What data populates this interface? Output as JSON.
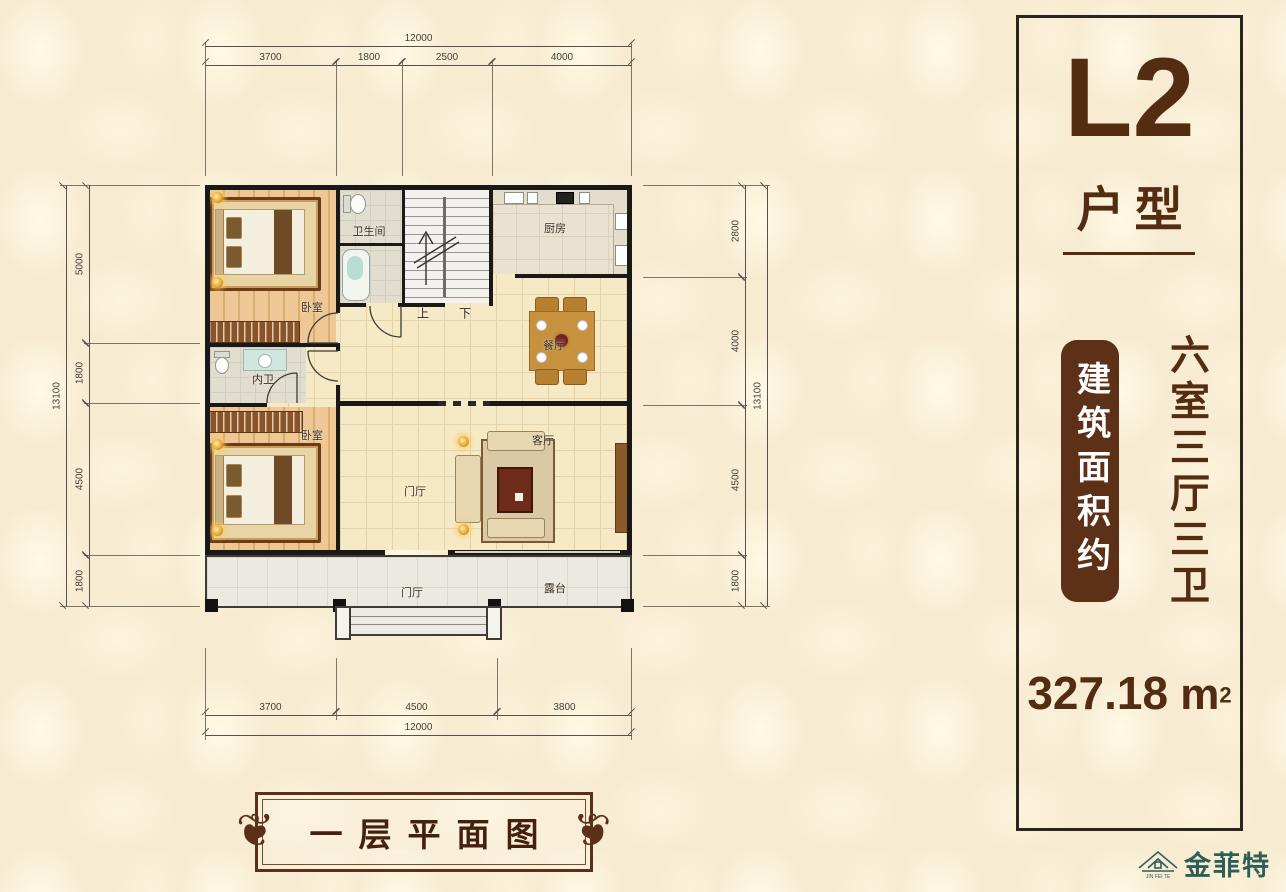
{
  "plan": {
    "rooms": {
      "bedroom_top": "卧室",
      "bedroom_bottom": "卧室",
      "bathroom": "卫生间",
      "inner_bathroom": "内卫",
      "kitchen": "厨房",
      "dining": "餐厅",
      "living": "客厅",
      "foyer": "门厅",
      "entry_foyer": "门厅",
      "terrace": "露台",
      "stairs_up": "上",
      "stairs_down": "下"
    },
    "dimensions": {
      "top": {
        "total": "12000",
        "segments": [
          "3700",
          "1800",
          "2500",
          "4000"
        ]
      },
      "bottom": {
        "total": "12000",
        "segments": [
          "3700",
          "4500",
          "3800"
        ]
      },
      "left": {
        "total": "13100",
        "segments": [
          "5000",
          "1800",
          "4500",
          "1800"
        ]
      },
      "right": {
        "total": "13100",
        "segments": [
          "2800",
          "4000",
          "4500",
          "1800"
        ]
      }
    }
  },
  "panel": {
    "code": "L2",
    "code_suffix": "户型",
    "area_box_label": "建筑面积约",
    "layout_summary": "六室三厅三卫",
    "area_value": "327.18",
    "area_unit": "m",
    "area_exponent": "2"
  },
  "footer": {
    "drawing_title": "一层平面图"
  },
  "logo": {
    "brand": "金菲特",
    "tagline": "JIN FEI TE"
  },
  "colors": {
    "accent_brown": "#532c12",
    "area_box_brown": "#5d3118",
    "frame_brown": "#5c3018",
    "logo_teal": "#2e5f57",
    "wall_black": "#1b1917",
    "background": "#f7ecd2"
  }
}
